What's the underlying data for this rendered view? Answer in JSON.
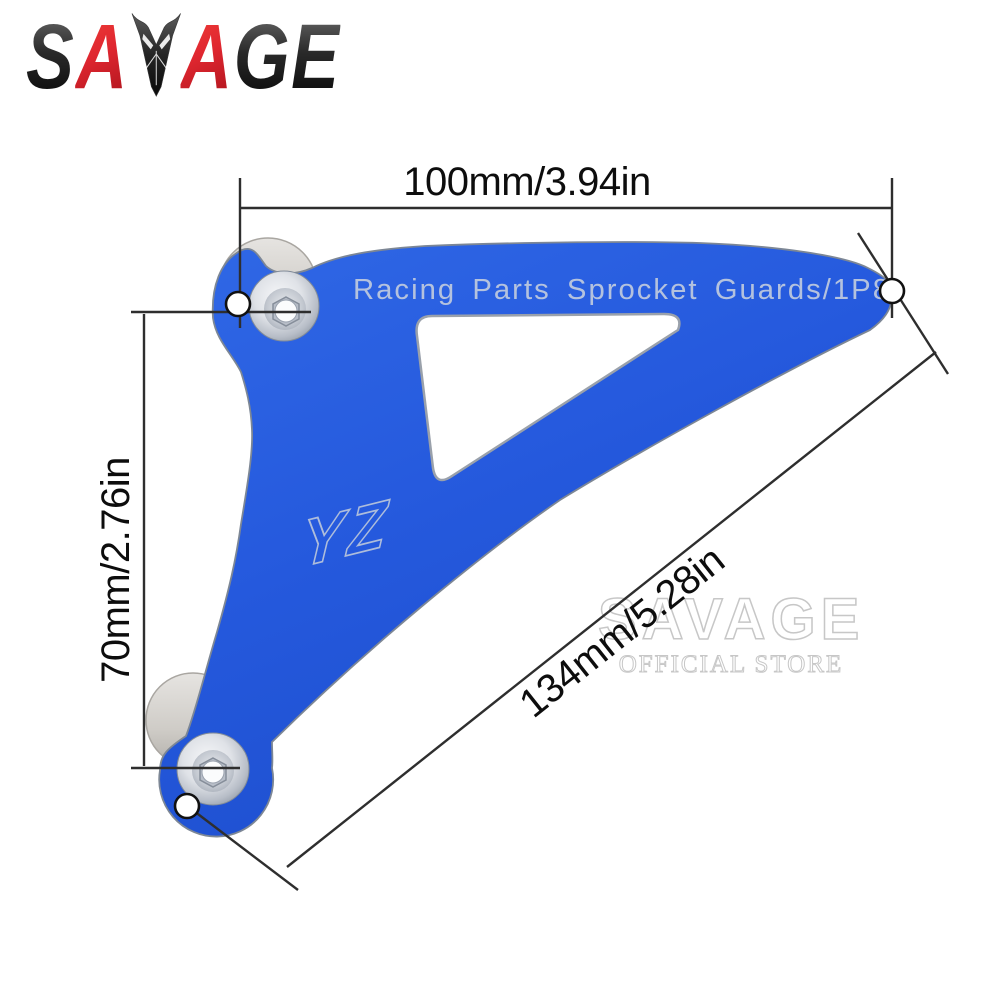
{
  "image_type": "product dimension diagram of a motorcycle front sprocket guard",
  "logo": {
    "text": "SAVAGE",
    "letters": [
      "S",
      "A",
      "A",
      "G",
      "E"
    ],
    "emblem_icon": "savage-emblem"
  },
  "product": {
    "part_name_engraving": "Racing Parts Sprocket Guards/1P8",
    "brand_engraving": "YZ",
    "part_color_name": "anodized blue"
  },
  "dimensions": {
    "top_width": "100mm/3.94in",
    "left_height": "70mm/2.76in",
    "diagonal_length": "134mm/5.28in"
  },
  "watermark": {
    "line1": "SAVAGE",
    "line2": "OFFICIAL STORE"
  },
  "colors": {
    "blue": "#2257d8",
    "blue_light": "#3068e6",
    "blue_dark": "#1d4ecd",
    "logo_red": "#df232c",
    "logo_black": "#141414",
    "steel": "#c9ced6",
    "spacer_gray": "#d5d3cf",
    "engraving": "#b4c2de",
    "dim_line": "#2e2e2e",
    "watermark_gray": "#c7c7c7",
    "background": "#ffffff"
  }
}
